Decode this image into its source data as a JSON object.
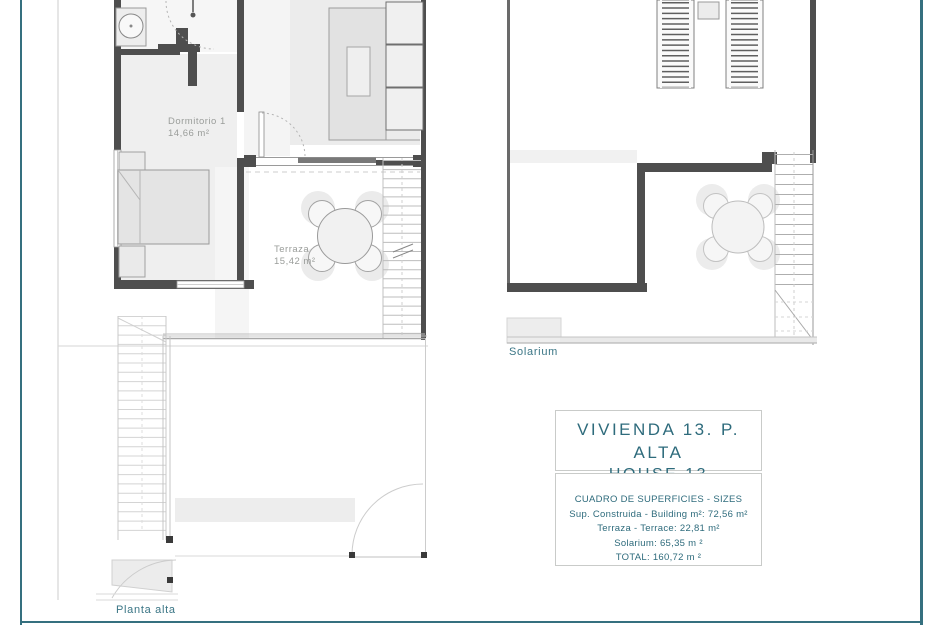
{
  "plans": {
    "planta_alta": {
      "caption": "Planta alta",
      "rooms": [
        {
          "name": "Dormitorio 1",
          "area": "14,66 m²"
        },
        {
          "name": "Terraza",
          "area": "15,42 m²"
        }
      ]
    },
    "solarium": {
      "caption": "Solarium"
    }
  },
  "info_panel": {
    "title_line1": "VIVIENDA 13. P. ALTA",
    "title_line2": "HOUSE 13",
    "surfaces": {
      "header": "CUADRO DE SUPERFICIES - SIZES",
      "rows": [
        "Sup. Construida - Building m²: 72,56 m²",
        "Terraza - Terrace: 22,81 m²",
        "Solarium: 65,35 m ²",
        "TOTAL: 160,72 m ²"
      ]
    }
  },
  "colors": {
    "accent_teal_border": "#35707f",
    "caption_teal": "#3a7585",
    "panel_text_teal": "#2e6b7c",
    "plan_label_gray": "#9a9d9a",
    "wall_dark_gray": "#4e4e4e"
  }
}
